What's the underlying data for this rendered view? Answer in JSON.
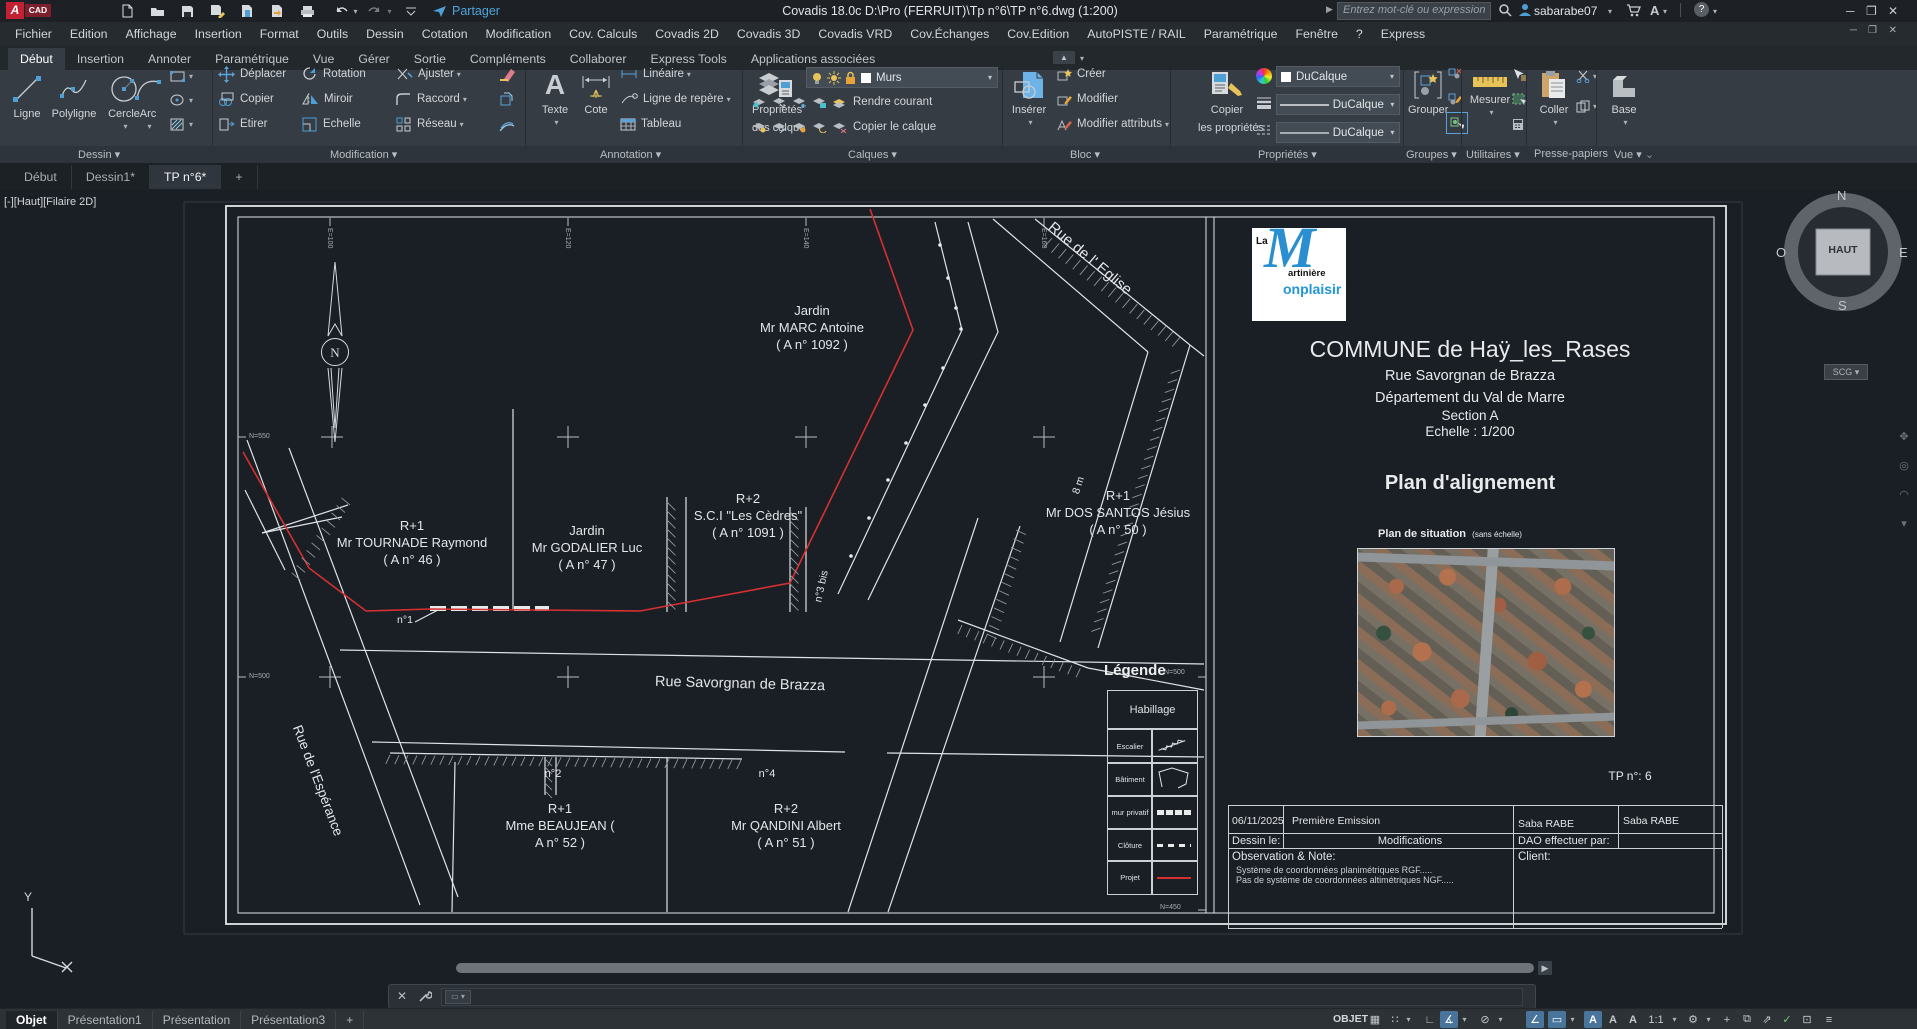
{
  "titlebar": {
    "logo_a": "A",
    "logo_cad": "CAD",
    "title": "Covadis 18.0c   D:\\Pro (FERRUIT)\\Tp n°6\\TP n°6.dwg (1:200)",
    "share_label": "Partager",
    "search_placeholder": "Entrez mot-clé ou expression",
    "username": "sabarabe07",
    "font_tool": "A",
    "help": "?"
  },
  "menubar": {
    "items": [
      "Fichier",
      "Edition",
      "Affichage",
      "Insertion",
      "Format",
      "Outils",
      "Dessin",
      "Cotation",
      "Modification",
      "Cov. Calculs",
      "Covadis 2D",
      "Covadis 3D",
      "Covadis VRD",
      "Cov.Échanges",
      "Cov.Edition",
      "AutoPISTE / RAIL",
      "Paramétrique",
      "Fenêtre",
      "?",
      "Express"
    ]
  },
  "ribbon": {
    "tabs": [
      {
        "label": "Début",
        "active": true
      },
      {
        "label": "Insertion"
      },
      {
        "label": "Annoter"
      },
      {
        "label": "Paramétrique"
      },
      {
        "label": "Vue"
      },
      {
        "label": "Gérer"
      },
      {
        "label": "Sortie"
      },
      {
        "label": "Compléments"
      },
      {
        "label": "Collaborer"
      },
      {
        "label": "Express Tools"
      },
      {
        "label": "Applications associées"
      }
    ],
    "panel_labels": [
      "Dessin",
      "Modification",
      "Annotation",
      "Calques",
      "Bloc",
      "Propriétés",
      "Groupes",
      "Utilitaires",
      "Presse-papiers",
      "Vue"
    ],
    "dessin": {
      "ligne": "Ligne",
      "polyligne": "Polyligne",
      "cercle": "Cercle",
      "arc": "Arc"
    },
    "modification": {
      "deplacer": "Déplacer",
      "copier": "Copier",
      "etirer": "Etirer",
      "rotation": "Rotation",
      "miroir": "Miroir",
      "echelle": "Echelle",
      "ajuster": "Ajuster",
      "raccord": "Raccord",
      "reseau": "Réseau"
    },
    "annotation": {
      "texte": "Texte",
      "cote": "Cote",
      "lineaire": "Linéaire",
      "repere": "Ligne de repère",
      "tableau": "Tableau"
    },
    "calques": {
      "prop1": "Propriétés",
      "prop2": "des calque",
      "layer_value": "Murs",
      "rendre": "Rendre courant",
      "copier": "Copier le calque"
    },
    "bloc": {
      "inserer": "Insérer",
      "creer": "Créer",
      "modifier": "Modifier",
      "attributs": "Modifier attributs"
    },
    "proprietes": {
      "copier1": "Copier",
      "copier2": "les propriétés",
      "combo1": "DuCalque",
      "combo2": "DuCalque",
      "combo3": "DuCalque"
    },
    "groupes": {
      "grouper": "Grouper"
    },
    "utilitaires": {
      "mesurer": "Mesurer"
    },
    "pressepapiers": {
      "coller": "Coller"
    },
    "vue": {
      "base": "Base"
    }
  },
  "file_tabs": {
    "items": [
      {
        "label": "Début"
      },
      {
        "label": "Dessin1*"
      },
      {
        "label": "TP n°6*",
        "active": true
      },
      {
        "label": "+"
      }
    ]
  },
  "viewport": {
    "overlay": "[-][Haut][Filaire 2D]",
    "viewcube": {
      "n": "N",
      "e": "E",
      "s": "S",
      "o": "O",
      "center": "HAUT",
      "scg": "SCG"
    },
    "ucs": {
      "y": "Y"
    }
  },
  "map": {
    "parcels": [
      {
        "l1": "Jardin",
        "l2": "Mr MARC Antoine",
        "l3": "( A   n° 1092 )"
      },
      {
        "l1": "R+1",
        "l2": "Mr TOURNADE Raymond",
        "l3": "( A   n° 46 )"
      },
      {
        "l1": "Jardin",
        "l2": "Mr GODALIER Luc",
        "l3": "( A   n° 47 )"
      },
      {
        "l1": "R+2",
        "l2": "S.C.I \"Les Cèdres\"",
        "l3": "( A   n° 1091 )"
      },
      {
        "l1": "R+1",
        "l2": "Mr DOS SANTOS Jésius",
        "l3": "( A   n° 50 )"
      },
      {
        "l1": "R+1",
        "l2": "Mme BEAUJEAN (",
        "l3": "A   n° 52 )"
      },
      {
        "l1": "R+2",
        "l2": "Mr QANDINI Albert",
        "l3": "( A   n° 51 )"
      }
    ],
    "streets": {
      "eglise": "Rue de l' Eglise",
      "savorgnan": "Rue Savorgnan de Brazza",
      "esperance": "Rue de l'Espérance"
    },
    "small_labels": {
      "n1": "n°1",
      "n2": "n°2",
      "n4": "n°4",
      "n3bis": "n°3 bis",
      "w8": "8 m"
    },
    "grid_labels": {
      "top": [
        "E=100",
        "E=120",
        "E=140",
        "E=160"
      ],
      "left": [
        "N=550",
        "N=500"
      ],
      "right": [
        "N=500",
        "N=450"
      ]
    },
    "legend": {
      "title": "Légende",
      "header": "Habillage",
      "rows": [
        "Escalier",
        "Bâtiment",
        "mur privatif",
        "Clôture",
        "Projet"
      ]
    }
  },
  "titleblock": {
    "logo": {
      "la": "La",
      "m": "M",
      "part1": "artinière",
      "part2": "onplaisir"
    },
    "commune": "COMMUNE de Haÿ_les_Rases",
    "street": "Rue Savorgnan de Brazza",
    "departement": "Département du Val de Marre",
    "section": "Section A",
    "echelle": "Echelle : 1/200",
    "plan_title": "Plan d'alignement",
    "situation": "Plan de situation",
    "situation_note": "(sans échelle)",
    "tp": "TP n°: 6",
    "table": {
      "date": "06/11/2025",
      "emission": "Première Emission",
      "name1": "Saba RABE",
      "name2": "Saba RABE",
      "dessin_le": "Dessin le:",
      "modifications": "Modifications",
      "dao": "DAO effectuer par:",
      "obs_title": "Observation & Note:",
      "obs1": "Système de coordonnées  planimétriques RGF.....",
      "obs2": "Pas de système de coordonnées altimétriques NGF.....",
      "client": "Client:"
    }
  },
  "statusbar": {
    "layout_tabs": [
      {
        "label": "Objet",
        "active": true
      },
      {
        "label": "Présentation1"
      },
      {
        "label": "Présentation"
      },
      {
        "label": "Présentation3"
      },
      {
        "label": "+"
      }
    ],
    "mode": "OBJET",
    "annot_scale": "1:1"
  },
  "colors": {
    "accent_blue": "#4e9fd6",
    "red_line": "#d63030",
    "toggle_on": "#49759c",
    "yellow": "#e8c35a"
  }
}
